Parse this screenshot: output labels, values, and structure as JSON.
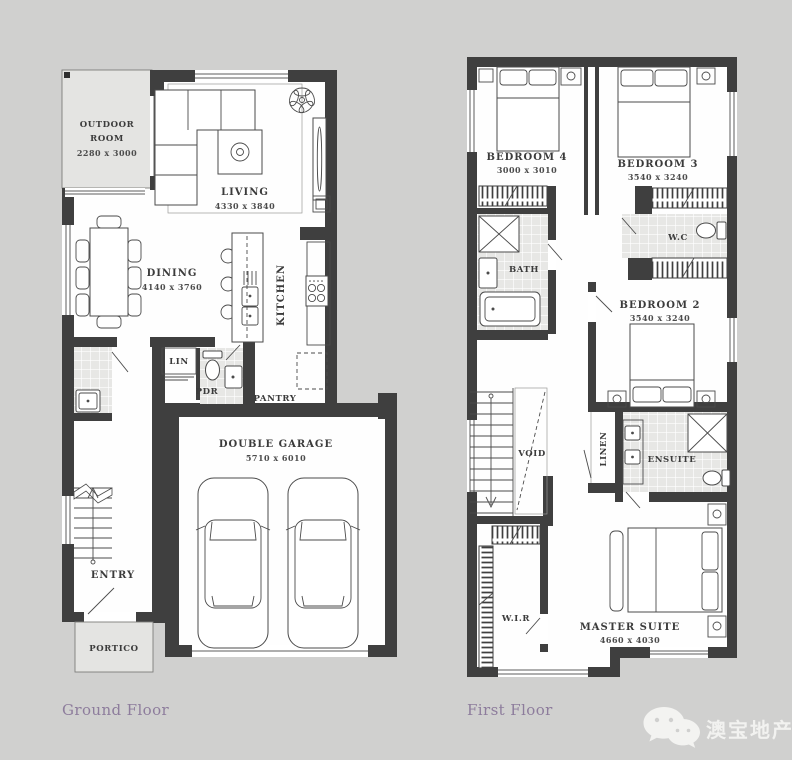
{
  "colors": {
    "background": "#d0d0cf",
    "wall": "#3f3f3f",
    "caption": "#8d7c9c",
    "watermark_text": "#f5f5f3"
  },
  "ground_floor": {
    "caption": "Ground Floor",
    "rooms": {
      "outdoor": {
        "line1": "OUTDOOR",
        "line2": "ROOM",
        "dims": "2280 x 3000"
      },
      "living": {
        "label": "LIVING",
        "dims": "4330 x 3840"
      },
      "dining": {
        "label": "DINING",
        "dims": "4140 x 3760"
      },
      "kitchen": {
        "label": "KITCHEN"
      },
      "linen": {
        "label": "LIN"
      },
      "powder": {
        "label": "PDR"
      },
      "pantry": {
        "label": "PANTRY"
      },
      "garage": {
        "label": "DOUBLE GARAGE",
        "dims": "5710 x 6010"
      },
      "entry": {
        "label": "ENTRY"
      },
      "portico": {
        "label": "PORTICO"
      }
    }
  },
  "first_floor": {
    "caption": "First Floor",
    "rooms": {
      "bedroom4": {
        "label": "BEDROOM 4",
        "dims": "3000 x 3010"
      },
      "bedroom3": {
        "label": "BEDROOM 3",
        "dims": "3540 x 3240"
      },
      "bath": {
        "label": "BATH"
      },
      "wc": {
        "label": "W.C"
      },
      "bedroom2": {
        "label": "BEDROOM 2",
        "dims": "3540 x 3240"
      },
      "void": {
        "label": "VOID"
      },
      "linen": {
        "label": "LINEN"
      },
      "ensuite": {
        "label": "ENSUITE"
      },
      "wir": {
        "label": "W.I.R"
      },
      "master": {
        "label": "MASTER SUITE",
        "dims": "4660 x 4030"
      }
    }
  },
  "watermark": {
    "brand": "澳宝地产"
  }
}
